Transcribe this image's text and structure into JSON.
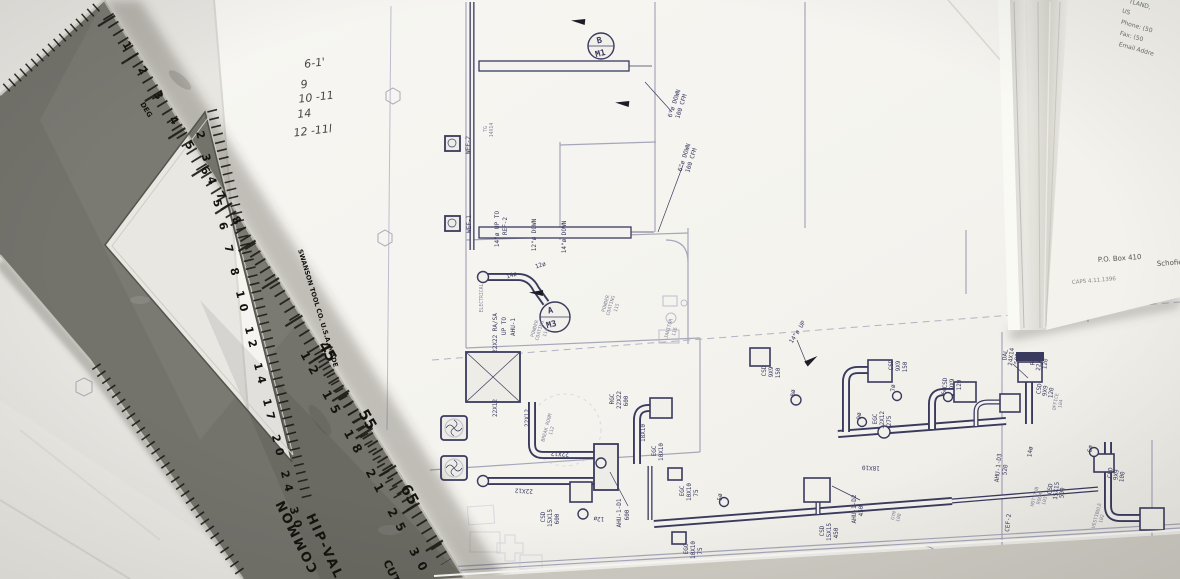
{
  "ruler": {
    "brand": "SWANSON TOOL CO. U.S.A. MADE",
    "deg_label": "DEG",
    "scale_names": {
      "hip_val": "HIP-VAL",
      "common": "COMMON",
      "cut": "CUT"
    },
    "deg_numbers": "1  2  3  4  5  6  7  8",
    "inner_numbers": "2 3 4 5 6 7 8 10 12 14 17 20 24 30",
    "mid_numbers": "12  15  18  21  25  30",
    "big_45": "45",
    "big_55": "55",
    "big_65": "65"
  },
  "handwritten_notes": [
    "6-1'",
    "9",
    "10 -11",
    "14",
    "12 -11l"
  ],
  "letterhead": {
    "lines": [
      "TLAND,",
      "US",
      "Phone:  (50",
      "Fax:  (50",
      "Email Addre"
    ],
    "po_box": "P.O. Box 410",
    "city": "Schofiel",
    "caps": "CAPS 4.11.1396"
  },
  "plan": {
    "labels": [
      "22X22 RA/SA",
      "UP TO",
      "AHU-1",
      "A",
      "M3",
      "B",
      "M1",
      "6\"ø DOWN",
      "100 CFM",
      "6\"ø DOWN",
      "100 CFM",
      "WEF-2",
      "WEF-1",
      "TG",
      "14X14",
      "14\"ø UP TO",
      "REF-2",
      "12\"ø DOWN",
      "14\"ø DOWN",
      "14ø",
      "12ø",
      "POWDER",
      "COATING",
      "114",
      "POWDER",
      "COATING",
      "115",
      "22X12",
      "22X12",
      "22X12",
      "22X12",
      "RGC",
      "22X22",
      "600",
      "BREAK ROOM",
      "112",
      "12ø",
      "CSD",
      "15X15",
      "600",
      "AHU-1-D1",
      "600",
      "EGC",
      "10X10",
      "EGC",
      "10X10",
      "75",
      "EGC",
      "10X10",
      "75",
      "14\"ø UP",
      "JANITOR",
      "116",
      "CSD",
      "9X9",
      "150",
      "CSD",
      "9X9",
      "150",
      "EGC",
      "12X12",
      "275",
      "CSD",
      "9X9",
      "120",
      "RGC",
      "22X22",
      "120",
      "DAL",
      "24X14",
      "500",
      "CSD",
      "9X9",
      "120",
      "14ø",
      "7ø",
      "9ø",
      "6ø",
      "8ø",
      "5ø",
      "6ø",
      "18X10",
      "18X10",
      "OFFICE",
      "104",
      "CSD",
      "15X15",
      "500",
      "CSD",
      "9X9",
      "100",
      "HOT TUB",
      "ROOM",
      "103",
      "VESTIBULE",
      "102",
      "CEF-2",
      "AHU-1-D3",
      "520",
      "CSD",
      "15X15",
      "450",
      "AHU-1-D2",
      "450",
      "GYM",
      "108",
      "EGC",
      "16X16",
      "500",
      "ELECTRICAL"
    ]
  }
}
